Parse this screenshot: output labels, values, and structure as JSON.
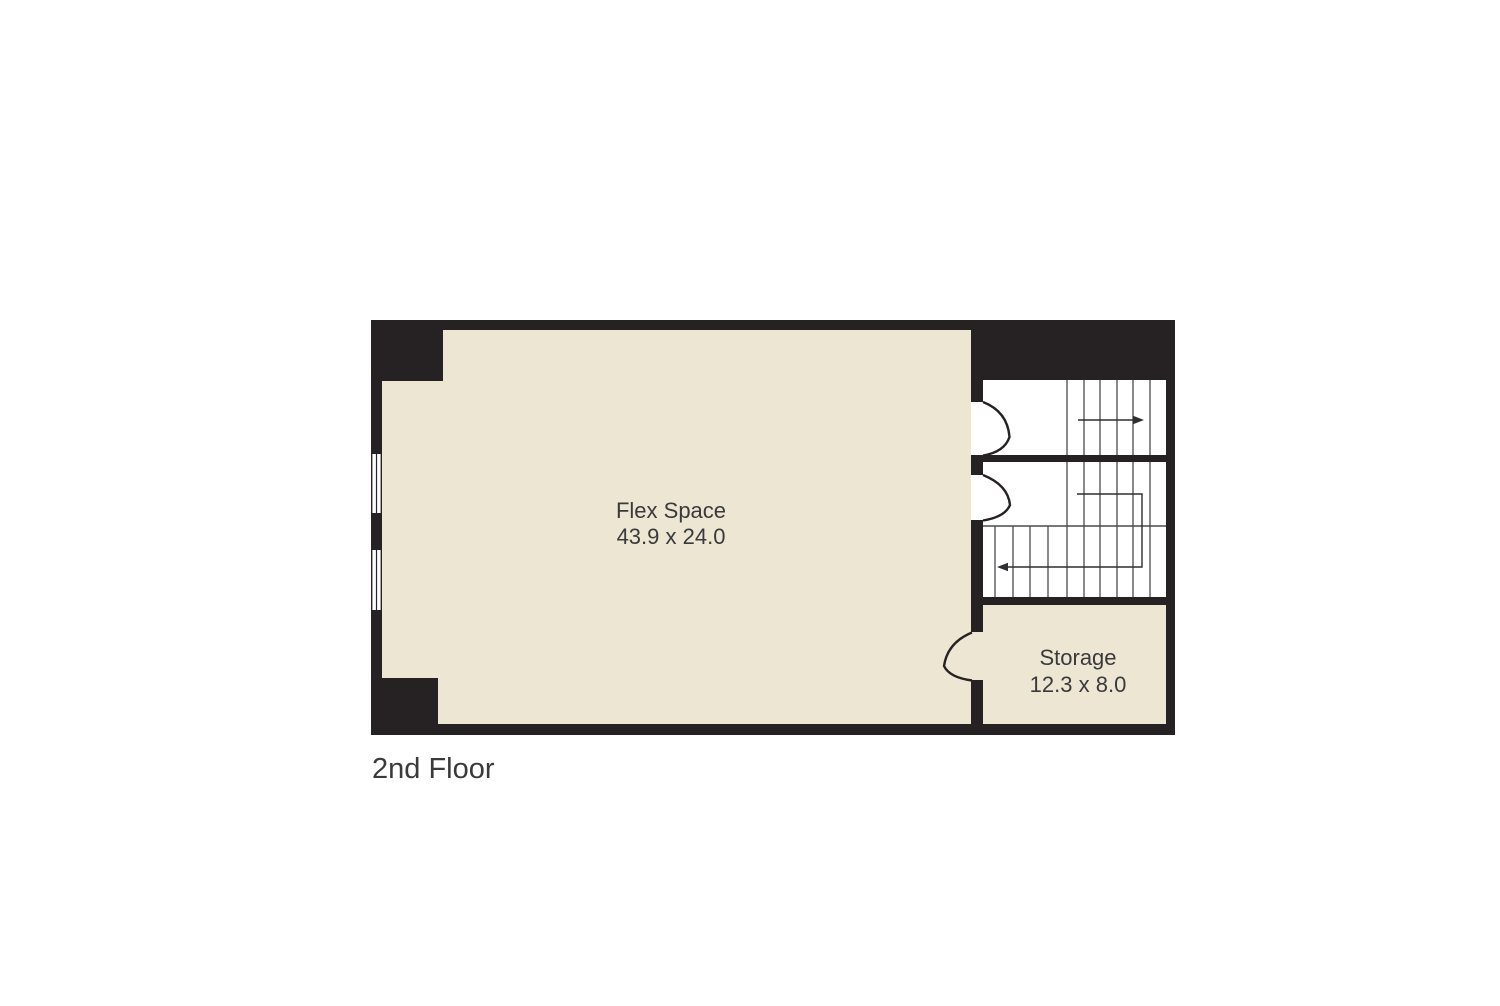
{
  "title": "2nd Floor plan",
  "floor_label": "2nd Floor",
  "rooms": {
    "flex": {
      "name": "Flex Space",
      "dimensions": "43.9 x 24.0"
    },
    "storage": {
      "name": "Storage",
      "dimensions": "12.3 x 8.0"
    }
  },
  "symbols": {
    "windows": 2,
    "doors": 3,
    "stairwells": 2,
    "stair_direction_arrows": 2
  },
  "colors": {
    "background": "#ffffff",
    "wall": "#262123",
    "room_fill": "#ece6d3",
    "stair_floor": "#ffffff",
    "tread_line": "#4a4b4e",
    "direction_line": "#2f2f31",
    "text": "#3a3a3c"
  }
}
